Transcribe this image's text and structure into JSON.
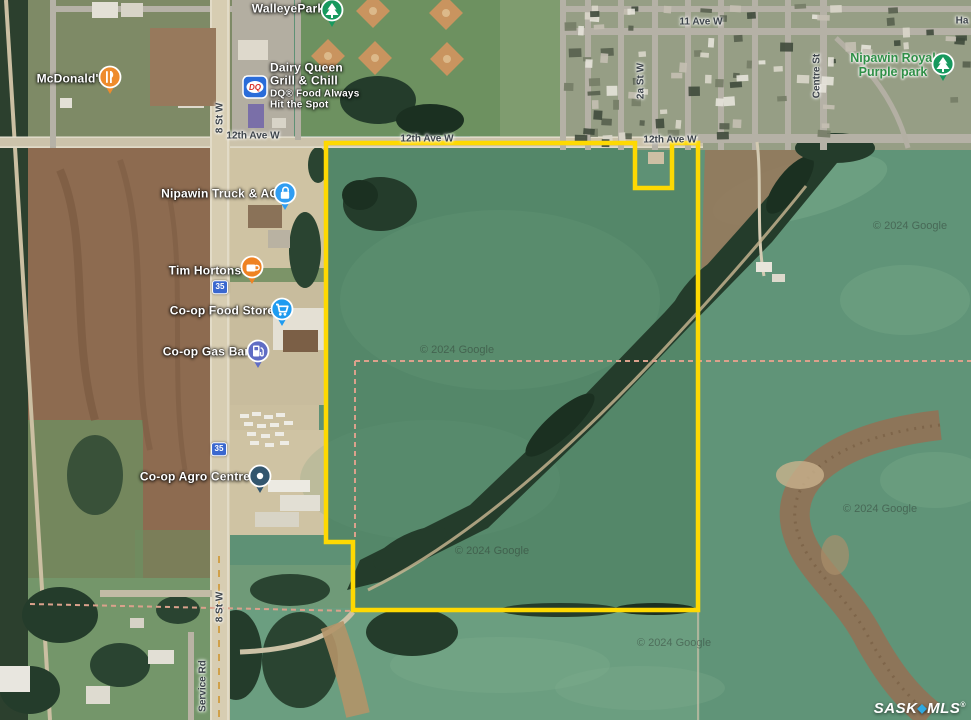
{
  "map": {
    "property_boundary_color": "#fed902",
    "parcel_dash_color": "#dba18c",
    "dq_logo_text": "DQ",
    "highway_badges": [
      {
        "id": "hwy-35-north",
        "label": "35",
        "x": 220,
        "y": 287
      },
      {
        "id": "hwy-35-south",
        "label": "35",
        "x": 219,
        "y": 449
      }
    ],
    "street_labels": [
      {
        "id": "12th-ave-w-west",
        "text": "12th Ave W",
        "x": 253,
        "y": 136,
        "rot": 0
      },
      {
        "id": "12th-ave-w-mid",
        "text": "12th Ave W",
        "x": 427,
        "y": 139,
        "rot": 0
      },
      {
        "id": "12th-ave-w-east",
        "text": "12th Ave W",
        "x": 670,
        "y": 140,
        "rot": 0
      },
      {
        "id": "11-ave-w",
        "text": "11 Ave W",
        "x": 701,
        "y": 22,
        "rot": 0
      },
      {
        "id": "2a-st-w",
        "text": "2a St W",
        "x": 641,
        "y": 81,
        "rot": -90
      },
      {
        "id": "centre-st",
        "text": "Centre St",
        "x": 817,
        "y": 76,
        "rot": -90
      },
      {
        "id": "8-st-w-north",
        "text": "8 St W",
        "x": 220,
        "y": 118,
        "rot": -90
      },
      {
        "id": "8-st-w-south",
        "text": "8 St W",
        "x": 220,
        "y": 607,
        "rot": -90
      },
      {
        "id": "service-rd",
        "text": "Service Rd",
        "x": 203,
        "y": 686,
        "rot": -90
      },
      {
        "id": "ha-partial",
        "text": "Ha",
        "x": 962,
        "y": 21,
        "rot": 0
      }
    ],
    "poi_labels": [
      {
        "id": "mcdonalds",
        "lines": [
          "McDonald's"
        ],
        "x": 71,
        "y": 79,
        "style": "poi"
      },
      {
        "id": "walleye-park",
        "lines": [
          "WalleyePark"
        ],
        "x": 288,
        "y": 9,
        "style": "poi"
      },
      {
        "id": "dairy-queen",
        "lines": [
          "Dairy Queen",
          "Grill & Chill"
        ],
        "sub": [
          "DQ® Food Always",
          "Hit the Spot"
        ],
        "x": 270,
        "y": 86,
        "style": "poi",
        "align": "left"
      },
      {
        "id": "nipawin-truck-ag",
        "lines": [
          "Nipawin Truck & AG"
        ],
        "x": 220,
        "y": 194,
        "style": "poi"
      },
      {
        "id": "tim-hortons",
        "lines": [
          "Tim Hortons"
        ],
        "x": 205,
        "y": 271,
        "style": "poi"
      },
      {
        "id": "coop-food-store",
        "lines": [
          "Co-op Food Store"
        ],
        "x": 222,
        "y": 311,
        "style": "poi"
      },
      {
        "id": "coop-gas-bar",
        "lines": [
          "Co-op Gas Bar"
        ],
        "x": 206,
        "y": 352,
        "style": "poi"
      },
      {
        "id": "coop-agro-centre",
        "lines": [
          "Co-op Agro Centre"
        ],
        "x": 195,
        "y": 477,
        "style": "poi"
      },
      {
        "id": "nipawin-royal-purple-park",
        "lines": [
          "Nipawin Royal",
          "Purple park"
        ],
        "x": 893,
        "y": 65,
        "style": "park"
      }
    ],
    "poi_icons": [
      {
        "id": "mcdonalds-pin",
        "glyph": "cutlery",
        "bg": "#ee8b2c",
        "x": 110,
        "y": 77,
        "shape": "pin"
      },
      {
        "id": "walleyepark-pin",
        "glyph": "tree",
        "bg": "#17995e",
        "x": 332,
        "y": 10,
        "shape": "pin"
      },
      {
        "id": "dq-logo",
        "glyph": "dq",
        "bg": "#2a6cd9",
        "x": 255,
        "y": 87,
        "shape": "square"
      },
      {
        "id": "nipawin-truck-ag-pin",
        "glyph": "lock",
        "bg": "#2f9df2",
        "x": 285,
        "y": 193,
        "shape": "pin"
      },
      {
        "id": "tim-hortons-pin",
        "glyph": "cup",
        "bg": "#ef8222",
        "x": 252,
        "y": 267,
        "shape": "pin"
      },
      {
        "id": "coop-food-store-pin",
        "glyph": "cart",
        "bg": "#1e9bf0",
        "x": 282,
        "y": 309,
        "shape": "pin"
      },
      {
        "id": "coop-gas-bar-pin",
        "glyph": "fuel",
        "bg": "#5f6cc4",
        "x": 258,
        "y": 351,
        "shape": "pin"
      },
      {
        "id": "coop-agro-centre-pin",
        "glyph": "dot",
        "bg": "#33566e",
        "x": 260,
        "y": 476,
        "shape": "pin"
      },
      {
        "id": "purple-park-pin",
        "glyph": "tree",
        "bg": "#17995e",
        "x": 943,
        "y": 64,
        "shape": "pin"
      }
    ],
    "google_watermark": {
      "text": "© 2024 Google",
      "positions": [
        {
          "x": 457,
          "y": 350
        },
        {
          "x": 492,
          "y": 551
        },
        {
          "x": 674,
          "y": 643
        },
        {
          "x": 880,
          "y": 509
        },
        {
          "x": 910,
          "y": 226
        }
      ]
    },
    "brand_watermark": {
      "sask": "SASK",
      "mls": "MLS",
      "reg": "®",
      "diamond": "◆",
      "diamond_color": "#2fa9e0"
    }
  }
}
